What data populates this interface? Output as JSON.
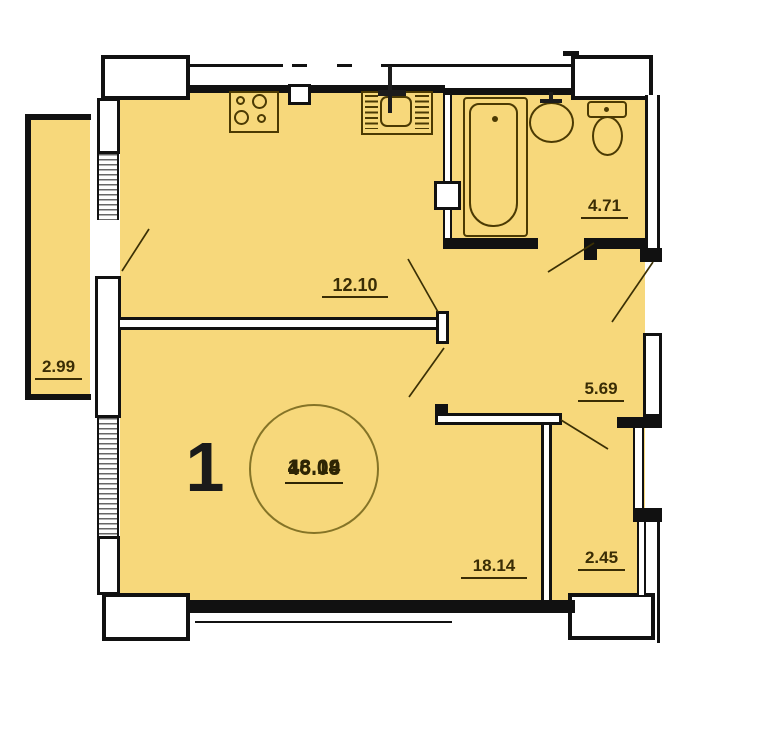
{
  "unit_number": "1",
  "stamp": {
    "living_area": "18.14",
    "area_without_balcony": "43.09",
    "total_area": "46.08"
  },
  "rooms": {
    "balcony": {
      "area": "2.99"
    },
    "kitchen": {
      "area": "12.10"
    },
    "bathroom": {
      "area": "4.71"
    },
    "hallway": {
      "area": "5.69"
    },
    "living_room": {
      "area": "18.14"
    },
    "storage": {
      "area": "2.45"
    }
  },
  "colors": {
    "room_fill": "#f7d87b",
    "wall": "#111111",
    "fixture_outline": "#4b3a03",
    "label_text": "#3a2d05",
    "stamp_ring": "#857427"
  }
}
